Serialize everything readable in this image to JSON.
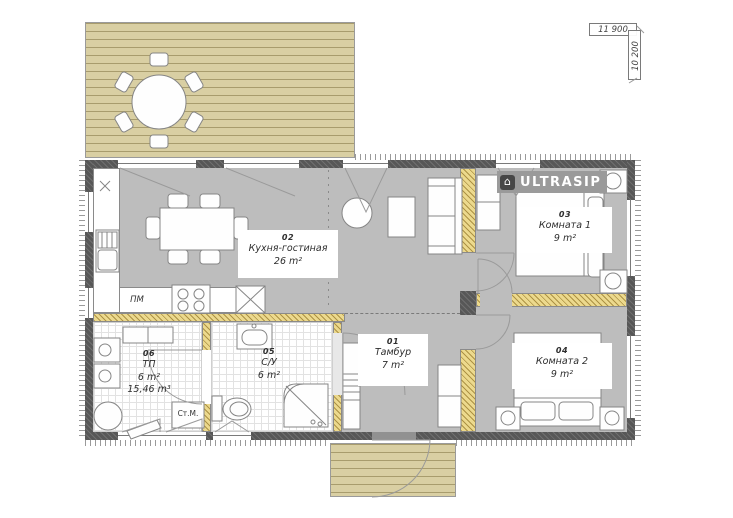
{
  "plan": {
    "brand": "ULTRASIP",
    "dimensions": {
      "width": "11 900",
      "height": "10 200"
    },
    "rooms": [
      {
        "number": "01",
        "name": "Тамбур",
        "area": "7 m²"
      },
      {
        "number": "02",
        "name": "Кухня-гостиная",
        "area": "26 m²"
      },
      {
        "number": "03",
        "name": "Комната 1",
        "area": "9 m²"
      },
      {
        "number": "04",
        "name": "Комната 2",
        "area": "9 m²"
      },
      {
        "number": "05",
        "name": "С/У",
        "area": "6 m²"
      },
      {
        "number": "06",
        "name": "ТП",
        "area": "6 m²",
        "volume": "15,46 m³"
      }
    ],
    "appliances": {
      "dishwasher": "ПМ",
      "washing_machine": "Ст.М."
    },
    "logo_icon": "house-icon",
    "colors": {
      "deck": "#d9cfa3",
      "floor_gray": "#bdbdbd",
      "wall": "#575757",
      "insulation": "#ecd98d",
      "logo_bg": "#9a9a9a"
    }
  }
}
